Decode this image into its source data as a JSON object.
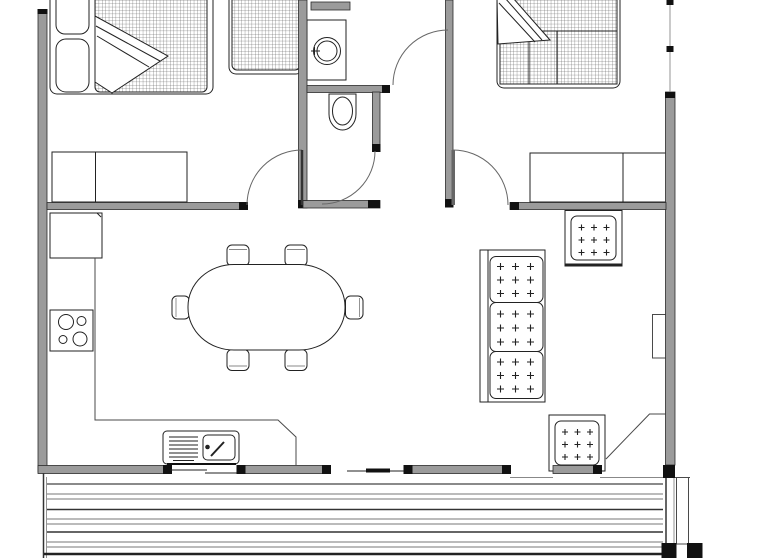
{
  "colors": {
    "background": "#ffffff",
    "wall_fill": "#9b9b9b",
    "wall_edge": "#2b2b2b",
    "cap": "#111111",
    "line": "#4a4a4a",
    "line_dark": "#222222",
    "line_light": "#888888",
    "hatch": "#555555"
  },
  "plan": {
    "type": "architectural-floor-plan",
    "rooms": [
      "bedroom-1",
      "bathroom",
      "hallway",
      "bedroom-2",
      "kitchen",
      "dining-area",
      "living-area",
      "deck"
    ],
    "furniture": {
      "bedroom_1": [
        "double-bed",
        "pillow",
        "pillow",
        "blanket-fold",
        "single-bed",
        "wardrobe"
      ],
      "bathroom": [
        "shelf",
        "vanity-counter",
        "basin",
        "toilet"
      ],
      "bedroom_2": [
        "double-bed",
        "blanket-fold",
        "wardrobe"
      ],
      "kitchen": [
        "refrigerator",
        "counter",
        "cooktop-4-burners",
        "sink-with-drainer"
      ],
      "dining_area": [
        "oval-table",
        "chair",
        "chair",
        "chair",
        "chair",
        "chair",
        "chair"
      ],
      "living_area": [
        "three-seat-sofa",
        "armchair",
        "armchair",
        "wall-niche",
        "corner-unit"
      ],
      "deck": [
        "decking-boards",
        "steps",
        "post",
        "post"
      ]
    },
    "doors": [
      "bedroom-1-door",
      "bathroom-door",
      "hall-door",
      "bedroom-2-door",
      "deck-opening",
      "sliding-opening"
    ],
    "windows": [
      "right-wall-window",
      "kitchen-sink-window",
      "living-room-window"
    ]
  }
}
